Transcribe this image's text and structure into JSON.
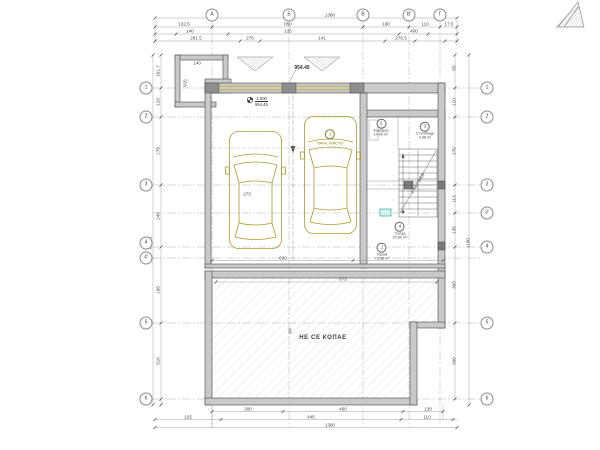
{
  "title": "Floor plan drawing (garage / foundation level)",
  "note": {
    "text": "НЕ СЕ КОПАЕ"
  },
  "level_top": {
    "value": "954.45"
  },
  "level_mark": {
    "line1": "-1.000",
    "line2": "954.45"
  },
  "colors": {
    "line": "#3b3b3b",
    "wall": "#c9c9c9",
    "wall_dark": "#8e8e8e",
    "column": "#7a7a7a",
    "car": "#ab9a27",
    "door": "#c0b13e",
    "hatch": "#dedede",
    "axis_line": "#b0b0b0",
    "accent_teal": "#2aa7a7"
  },
  "axes": {
    "top": [
      {
        "label": "А",
        "x": 212,
        "y": 15
      },
      {
        "label": "Б",
        "x": 289,
        "y": 15
      },
      {
        "label": "В",
        "x": 363,
        "y": 15
      },
      {
        "label": "В'",
        "x": 409,
        "y": 15
      },
      {
        "label": "Г",
        "x": 440,
        "y": 15
      }
    ],
    "left": [
      {
        "label": "1",
        "x": 146,
        "y": 88
      },
      {
        "label": "2",
        "x": 146,
        "y": 117
      },
      {
        "label": "3",
        "x": 146,
        "y": 185
      },
      {
        "label": "4",
        "x": 146,
        "y": 243
      },
      {
        "label": "4'",
        "x": 146,
        "y": 258
      },
      {
        "label": "5",
        "x": 146,
        "y": 323
      },
      {
        "label": "6",
        "x": 146,
        "y": 399
      }
    ],
    "right": [
      {
        "label": "1",
        "x": 487,
        "y": 88
      },
      {
        "label": "2",
        "x": 487,
        "y": 117
      },
      {
        "label": "3",
        "x": 487,
        "y": 185
      },
      {
        "label": "3'",
        "x": 487,
        "y": 213
      },
      {
        "label": "4",
        "x": 487,
        "y": 247
      },
      {
        "label": "5",
        "x": 487,
        "y": 323
      },
      {
        "label": "6",
        "x": 487,
        "y": 399
      }
    ]
  },
  "dimension_labels": [
    {
      "t": "1380",
      "x": 330,
      "y": 15.5
    },
    {
      "t": "132.5",
      "x": 184,
      "y": 24.5
    },
    {
      "t": "850",
      "x": 288,
      "y": 24.5
    },
    {
      "t": "190",
      "x": 386,
      "y": 24.5
    },
    {
      "t": "110",
      "x": 425,
      "y": 24.5
    },
    {
      "t": "17.5",
      "x": 449,
      "y": 24.5
    },
    {
      "t": "140",
      "x": 190,
      "y": 31.5
    },
    {
      "t": "135",
      "x": 288,
      "y": 31.5
    },
    {
      "t": "400",
      "x": 414,
      "y": 31.5
    },
    {
      "t": "281.5",
      "x": 196,
      "y": 38.5
    },
    {
      "t": "276",
      "x": 250,
      "y": 38.5
    },
    {
      "t": "141",
      "x": 322,
      "y": 38.5
    },
    {
      "t": "276.5",
      "x": 401,
      "y": 38.5
    },
    {
      "t": "1111.1",
      "x": 150.5,
      "y": 243,
      "rot": -90
    },
    {
      "t": "161.7",
      "x": 158.5,
      "y": 71,
      "rot": -90
    },
    {
      "t": "120",
      "x": 158.5,
      "y": 102,
      "rot": -90
    },
    {
      "t": "278",
      "x": 158.5,
      "y": 151,
      "rot": -90
    },
    {
      "t": "240",
      "x": 158.5,
      "y": 216,
      "rot": -90
    },
    {
      "t": "188",
      "x": 158.5,
      "y": 290,
      "rot": -90
    },
    {
      "t": "310",
      "x": 158.5,
      "y": 361,
      "rot": -90
    },
    {
      "t": "55",
      "x": 455,
      "y": 68,
      "rot": -90
    },
    {
      "t": "120",
      "x": 455,
      "y": 102,
      "rot": -90
    },
    {
      "t": "270",
      "x": 455,
      "y": 151,
      "rot": -90
    },
    {
      "t": "113",
      "x": 455,
      "y": 199,
      "rot": -90
    },
    {
      "t": "135",
      "x": 455,
      "y": 230,
      "rot": -90
    },
    {
      "t": "300",
      "x": 455,
      "y": 285,
      "rot": -90
    },
    {
      "t": "300",
      "x": 455,
      "y": 361,
      "rot": -90
    },
    {
      "t": "1180",
      "x": 469,
      "y": 243,
      "rot": -90
    },
    {
      "t": "300",
      "x": 248,
      "y": 410
    },
    {
      "t": "480",
      "x": 343,
      "y": 410
    },
    {
      "t": "130",
      "x": 428,
      "y": 410
    },
    {
      "t": "125",
      "x": 188,
      "y": 418
    },
    {
      "t": "445",
      "x": 311,
      "y": 418
    },
    {
      "t": "110",
      "x": 427,
      "y": 418
    },
    {
      "t": "1380",
      "x": 330,
      "y": 426
    },
    {
      "t": "600",
      "x": 283,
      "y": 258.5
    },
    {
      "t": "873",
      "x": 343,
      "y": 280
    },
    {
      "t": "273",
      "x": 247,
      "y": 195
    },
    {
      "t": "915",
      "x": 186,
      "y": 83,
      "rot": -90
    },
    {
      "t": "80",
      "x": 291,
      "y": 331,
      "rot": -90
    },
    {
      "t": "140",
      "x": 197,
      "y": 63.5
    },
    {
      "t": "17x17.5/28",
      "x": 418,
      "y": 184,
      "rot": -58
    }
  ],
  "rooms": [
    {
      "num": "1",
      "name": "Гараж",
      "area": "73.08 m²",
      "x": 382,
      "y": 252
    },
    {
      "num": "2",
      "name": "Коридор",
      "area": "14.90 m²",
      "x": 381,
      "y": 128
    },
    {
      "num": "3",
      "name": "Стълбище",
      "area": "4.88 m²",
      "x": 425,
      "y": 131
    },
    {
      "num": "4",
      "name": "Склад",
      "area": "15.80 m²",
      "x": 400,
      "y": 231
    }
  ],
  "parking_labels": [
    {
      "num": "1",
      "label": "ПАРК. МЯСТО",
      "x": 330,
      "y": 137
    }
  ]
}
